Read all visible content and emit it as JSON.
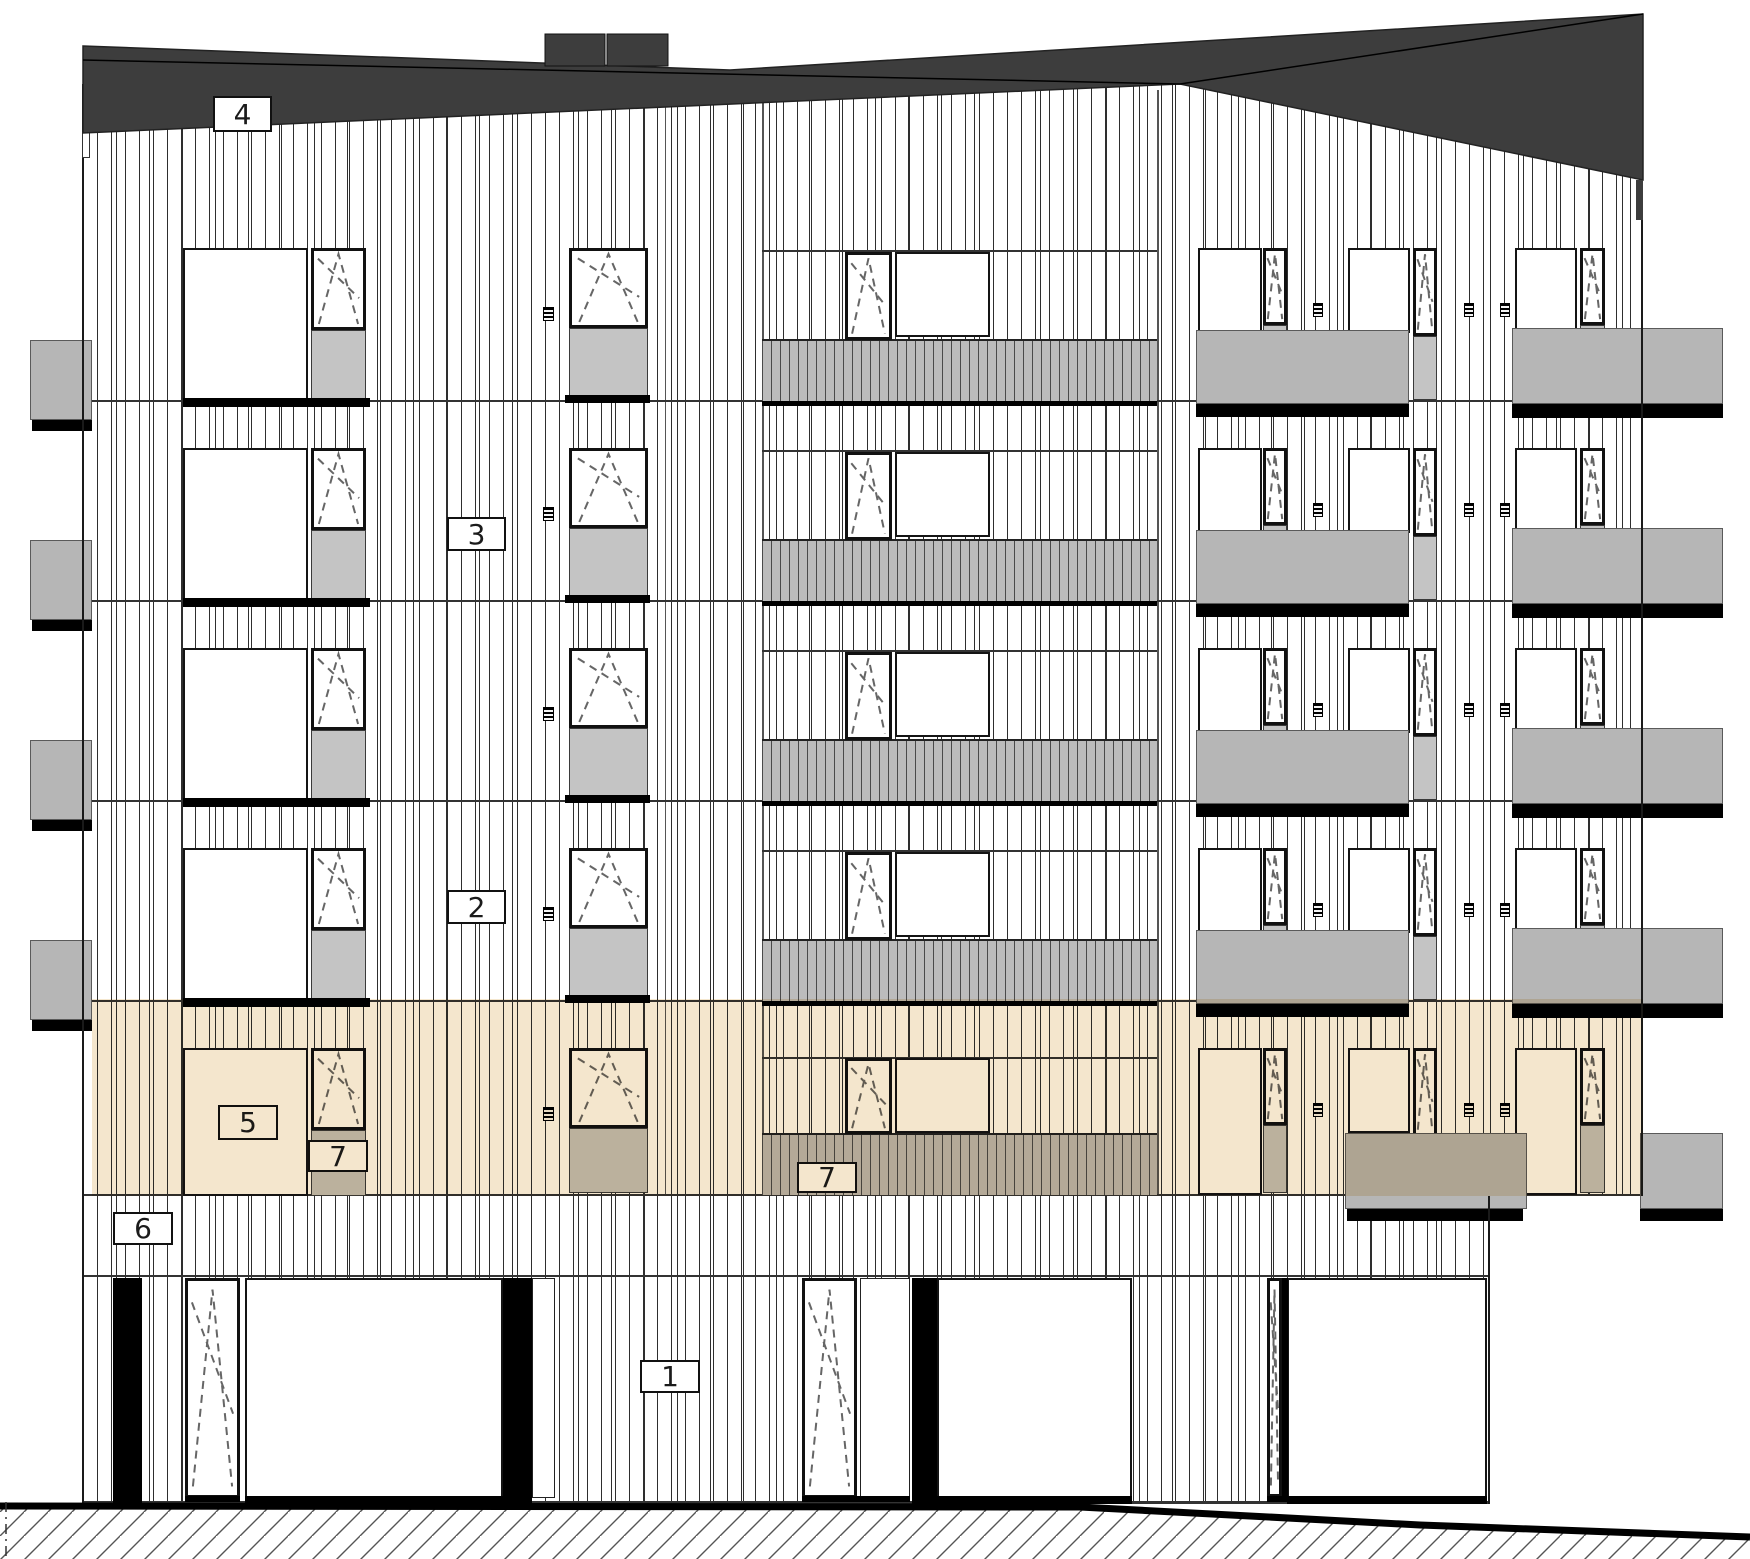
{
  "drawing": {
    "title": "Building facade elevation drawing",
    "type": "architectural-elevation",
    "floors_above_ground": 5,
    "highlighted_floor": "first floor band (beige)"
  },
  "colors": {
    "roof": "#3d3d3d",
    "line": "#1a1a1a",
    "siding_line": "#2e2e2e",
    "panel_gray": "#c4c4c4",
    "balcony_gray": "#b6b6b6",
    "shadow_black": "#000000",
    "highlight_beige": "#f4e6cd",
    "paper_white": "#ffffff"
  },
  "callouts": [
    {
      "text": "4",
      "x": 213,
      "y": 96,
      "w": 59,
      "h": 36,
      "tinted": false
    },
    {
      "text": "3",
      "x": 447,
      "y": 517,
      "w": 59,
      "h": 34,
      "tinted": false
    },
    {
      "text": "2",
      "x": 447,
      "y": 890,
      "w": 59,
      "h": 34,
      "tinted": false
    },
    {
      "text": "5",
      "x": 218,
      "y": 1105,
      "w": 60,
      "h": 35,
      "tinted": true
    },
    {
      "text": "7",
      "x": 308,
      "y": 1140,
      "w": 60,
      "h": 32,
      "tinted": true
    },
    {
      "text": "7",
      "x": 797,
      "y": 1162,
      "w": 60,
      "h": 31,
      "tinted": true
    },
    {
      "text": "6",
      "x": 113,
      "y": 1212,
      "w": 60,
      "h": 33,
      "tinted": false
    },
    {
      "text": "1",
      "x": 640,
      "y": 1360,
      "w": 60,
      "h": 33,
      "tinted": false
    }
  ],
  "highlight": {
    "x": 92,
    "y": 999,
    "w": 1551,
    "h": 197
  },
  "roof": {
    "outline": "83,46 730,70 1643,14 1643,180 1180,84 83,133",
    "ridge": "83,60 1180,84 1643,14",
    "right_strip": [
      1636,
      180,
      7,
      40
    ],
    "penthouse": [
      [
        545,
        34,
        60,
        32
      ],
      [
        607,
        34,
        61,
        32
      ]
    ]
  },
  "terrain": {
    "line": [
      [
        0,
        1506
      ],
      [
        1080,
        1507
      ],
      [
        1420,
        1525
      ],
      [
        1750,
        1537
      ]
    ],
    "hatch_close": [
      [
        1750,
        1559
      ],
      [
        0,
        1559
      ]
    ],
    "boundary_dash_x": 6
  },
  "geometry": {
    "facades": [
      [
        83,
        84,
        1407,
        1419
      ],
      [
        1490,
        84,
        153,
        1112
      ]
    ],
    "joints": [
      [
        762,
        90,
        2,
        1104
      ],
      [
        1157,
        90,
        2,
        1104
      ],
      [
        665,
        90,
        1,
        1104
      ]
    ],
    "floorlines": [
      [
        83,
        400,
        1560,
        2
      ],
      [
        83,
        600,
        1560,
        2
      ],
      [
        83,
        800,
        1560,
        2
      ],
      [
        83,
        1000,
        1560,
        2
      ],
      [
        83,
        1194,
        1560,
        2
      ],
      [
        83,
        1275,
        1407,
        2
      ],
      [
        83,
        1501,
        1407,
        3
      ]
    ],
    "headers": [
      [
        762,
        250,
        395,
        2
      ],
      [
        762,
        450,
        395,
        2
      ],
      [
        762,
        650,
        395,
        2
      ],
      [
        762,
        850,
        395,
        2
      ],
      [
        762,
        1057,
        395,
        2
      ]
    ],
    "windows": [
      [
        183,
        248,
        125,
        152
      ],
      [
        183,
        448,
        125,
        152
      ],
      [
        183,
        648,
        125,
        152
      ],
      [
        183,
        848,
        125,
        152
      ],
      [
        183,
        1048,
        125,
        148
      ],
      [
        895,
        252,
        95,
        85
      ],
      [
        895,
        452,
        95,
        85
      ],
      [
        895,
        652,
        95,
        85
      ],
      [
        895,
        852,
        95,
        85
      ],
      [
        895,
        1058,
        95,
        75
      ],
      [
        1198,
        248,
        64,
        152
      ],
      [
        1198,
        448,
        64,
        152
      ],
      [
        1198,
        648,
        64,
        152
      ],
      [
        1198,
        848,
        64,
        152
      ],
      [
        1198,
        1048,
        64,
        147
      ],
      [
        1348,
        248,
        62,
        85
      ],
      [
        1348,
        448,
        62,
        85
      ],
      [
        1348,
        648,
        62,
        85
      ],
      [
        1348,
        848,
        62,
        85
      ],
      [
        1348,
        1048,
        62,
        85
      ],
      [
        1515,
        248,
        62,
        152
      ],
      [
        1515,
        448,
        62,
        152
      ],
      [
        1515,
        648,
        62,
        152
      ],
      [
        1515,
        848,
        62,
        152
      ],
      [
        1515,
        1048,
        62,
        147
      ],
      [
        245,
        1278,
        258,
        220
      ],
      [
        937,
        1278,
        195,
        222
      ],
      [
        1287,
        1278,
        200,
        220
      ]
    ],
    "panels": [
      [
        532,
        1278,
        23,
        220
      ],
      [
        860,
        1278,
        50,
        220
      ]
    ],
    "casements": [
      [
        311,
        248,
        55,
        82
      ],
      [
        311,
        448,
        55,
        82
      ],
      [
        311,
        648,
        55,
        82
      ],
      [
        311,
        848,
        55,
        82
      ],
      [
        311,
        1048,
        55,
        82
      ],
      [
        569,
        248,
        79,
        80
      ],
      [
        569,
        448,
        79,
        80
      ],
      [
        569,
        648,
        79,
        80
      ],
      [
        569,
        848,
        79,
        80
      ],
      [
        569,
        1048,
        79,
        80
      ],
      [
        845,
        252,
        47,
        88
      ],
      [
        845,
        452,
        47,
        88
      ],
      [
        845,
        652,
        47,
        88
      ],
      [
        845,
        852,
        47,
        88
      ],
      [
        845,
        1058,
        47,
        76
      ],
      [
        1263,
        248,
        24,
        77
      ],
      [
        1263,
        448,
        24,
        77
      ],
      [
        1263,
        648,
        24,
        77
      ],
      [
        1263,
        848,
        24,
        77
      ],
      [
        1263,
        1048,
        24,
        77
      ],
      [
        1413,
        248,
        24,
        88
      ],
      [
        1413,
        448,
        24,
        88
      ],
      [
        1413,
        648,
        24,
        88
      ],
      [
        1413,
        848,
        24,
        88
      ],
      [
        1413,
        1048,
        24,
        88
      ],
      [
        1580,
        248,
        25,
        77
      ],
      [
        1580,
        448,
        25,
        77
      ],
      [
        1580,
        648,
        25,
        77
      ],
      [
        1580,
        848,
        25,
        77
      ],
      [
        1580,
        1048,
        25,
        77
      ],
      [
        185,
        1278,
        55,
        220
      ],
      [
        802,
        1278,
        55,
        220
      ],
      [
        1267,
        1278,
        15,
        219
      ]
    ],
    "spandrels": [
      [
        311,
        330,
        55,
        70
      ],
      [
        311,
        530,
        55,
        70
      ],
      [
        311,
        730,
        55,
        70
      ],
      [
        311,
        930,
        55,
        70
      ],
      [
        311,
        1130,
        55,
        66
      ],
      [
        569,
        328,
        79,
        68
      ],
      [
        569,
        528,
        79,
        68
      ],
      [
        569,
        728,
        79,
        68
      ],
      [
        569,
        928,
        79,
        68
      ],
      [
        569,
        1128,
        79,
        65
      ],
      [
        1263,
        325,
        24,
        73
      ],
      [
        1263,
        525,
        24,
        73
      ],
      [
        1263,
        725,
        24,
        73
      ],
      [
        1263,
        925,
        24,
        73
      ],
      [
        1263,
        1125,
        24,
        68
      ],
      [
        1413,
        336,
        24,
        64
      ],
      [
        1413,
        536,
        24,
        64
      ],
      [
        1413,
        736,
        24,
        64
      ],
      [
        1413,
        936,
        24,
        64
      ],
      [
        1580,
        325,
        25,
        73
      ],
      [
        1580,
        525,
        25,
        73
      ],
      [
        1580,
        725,
        25,
        73
      ],
      [
        1580,
        925,
        25,
        73
      ],
      [
        1580,
        1125,
        25,
        68
      ]
    ],
    "railings": [
      [
        762,
        339,
        395,
        62
      ],
      [
        762,
        539,
        395,
        62
      ],
      [
        762,
        739,
        395,
        62
      ],
      [
        762,
        939,
        395,
        62
      ],
      [
        762,
        1133,
        395,
        62
      ]
    ],
    "slabs": [
      [
        1196,
        330,
        213,
        74
      ],
      [
        1196,
        530,
        213,
        74
      ],
      [
        1196,
        730,
        213,
        74
      ],
      [
        1196,
        930,
        213,
        74
      ],
      [
        1512,
        328,
        211,
        76
      ],
      [
        1512,
        528,
        211,
        76
      ],
      [
        1512,
        728,
        211,
        76
      ],
      [
        1512,
        928,
        211,
        76
      ],
      [
        30,
        340,
        62,
        80
      ],
      [
        30,
        540,
        62,
        80
      ],
      [
        30,
        740,
        62,
        80
      ],
      [
        30,
        940,
        62,
        80
      ],
      [
        1345,
        1133,
        182,
        76
      ],
      [
        1640,
        1133,
        83,
        76
      ]
    ],
    "shadows": [
      [
        1196,
        404,
        213,
        13
      ],
      [
        1196,
        604,
        213,
        13
      ],
      [
        1196,
        804,
        213,
        13
      ],
      [
        1196,
        1004,
        213,
        13
      ],
      [
        1512,
        404,
        211,
        14
      ],
      [
        1512,
        604,
        211,
        14
      ],
      [
        1512,
        804,
        211,
        14
      ],
      [
        1512,
        1004,
        211,
        14
      ],
      [
        32,
        420,
        60,
        11
      ],
      [
        32,
        620,
        60,
        11
      ],
      [
        32,
        820,
        60,
        11
      ],
      [
        32,
        1020,
        60,
        11
      ],
      [
        762,
        401,
        395,
        5
      ],
      [
        762,
        601,
        395,
        5
      ],
      [
        762,
        801,
        395,
        5
      ],
      [
        762,
        1001,
        395,
        5
      ],
      [
        1347,
        1209,
        176,
        12
      ],
      [
        1640,
        1209,
        83,
        12
      ]
    ],
    "sills": [
      [
        183,
        398,
        187,
        9
      ],
      [
        183,
        598,
        187,
        9
      ],
      [
        183,
        798,
        187,
        9
      ],
      [
        183,
        998,
        187,
        9
      ],
      [
        565,
        395,
        85,
        8
      ],
      [
        565,
        595,
        85,
        8
      ],
      [
        565,
        795,
        85,
        8
      ],
      [
        565,
        995,
        85,
        8
      ],
      [
        245,
        1496,
        258,
        8
      ],
      [
        937,
        1496,
        195,
        8
      ],
      [
        1287,
        1496,
        200,
        8
      ],
      [
        185,
        1496,
        55,
        6
      ],
      [
        802,
        1496,
        108,
        6
      ],
      [
        1267,
        1496,
        21,
        6
      ]
    ],
    "grilles": [
      [
        543,
        307,
        11,
        14
      ],
      [
        543,
        507,
        11,
        14
      ],
      [
        543,
        707,
        11,
        14
      ],
      [
        543,
        907,
        11,
        14
      ],
      [
        543,
        1107,
        11,
        14
      ],
      [
        1313,
        303,
        10,
        14
      ],
      [
        1313,
        503,
        10,
        14
      ],
      [
        1313,
        703,
        10,
        14
      ],
      [
        1313,
        903,
        10,
        14
      ],
      [
        1313,
        1103,
        10,
        14
      ],
      [
        1464,
        303,
        10,
        14
      ],
      [
        1464,
        503,
        10,
        14
      ],
      [
        1464,
        703,
        10,
        14
      ],
      [
        1464,
        903,
        10,
        14
      ],
      [
        1464,
        1103,
        10,
        14
      ],
      [
        1500,
        303,
        10,
        14
      ],
      [
        1500,
        503,
        10,
        14
      ],
      [
        1500,
        703,
        10,
        14
      ],
      [
        1500,
        903,
        10,
        14
      ],
      [
        1500,
        1103,
        10,
        14
      ]
    ],
    "columns": [
      [
        113,
        1278,
        29,
        226
      ],
      [
        503,
        1278,
        29,
        226
      ],
      [
        912,
        1278,
        25,
        226
      ],
      [
        1282,
        1278,
        6,
        221
      ]
    ],
    "edges": [
      [
        82,
        84,
        2,
        1420
      ],
      [
        1641,
        84,
        2,
        1112
      ],
      [
        1488,
        1196,
        2,
        308
      ]
    ],
    "whitesteps": [
      [
        82,
        132,
        8,
        26
      ]
    ]
  }
}
